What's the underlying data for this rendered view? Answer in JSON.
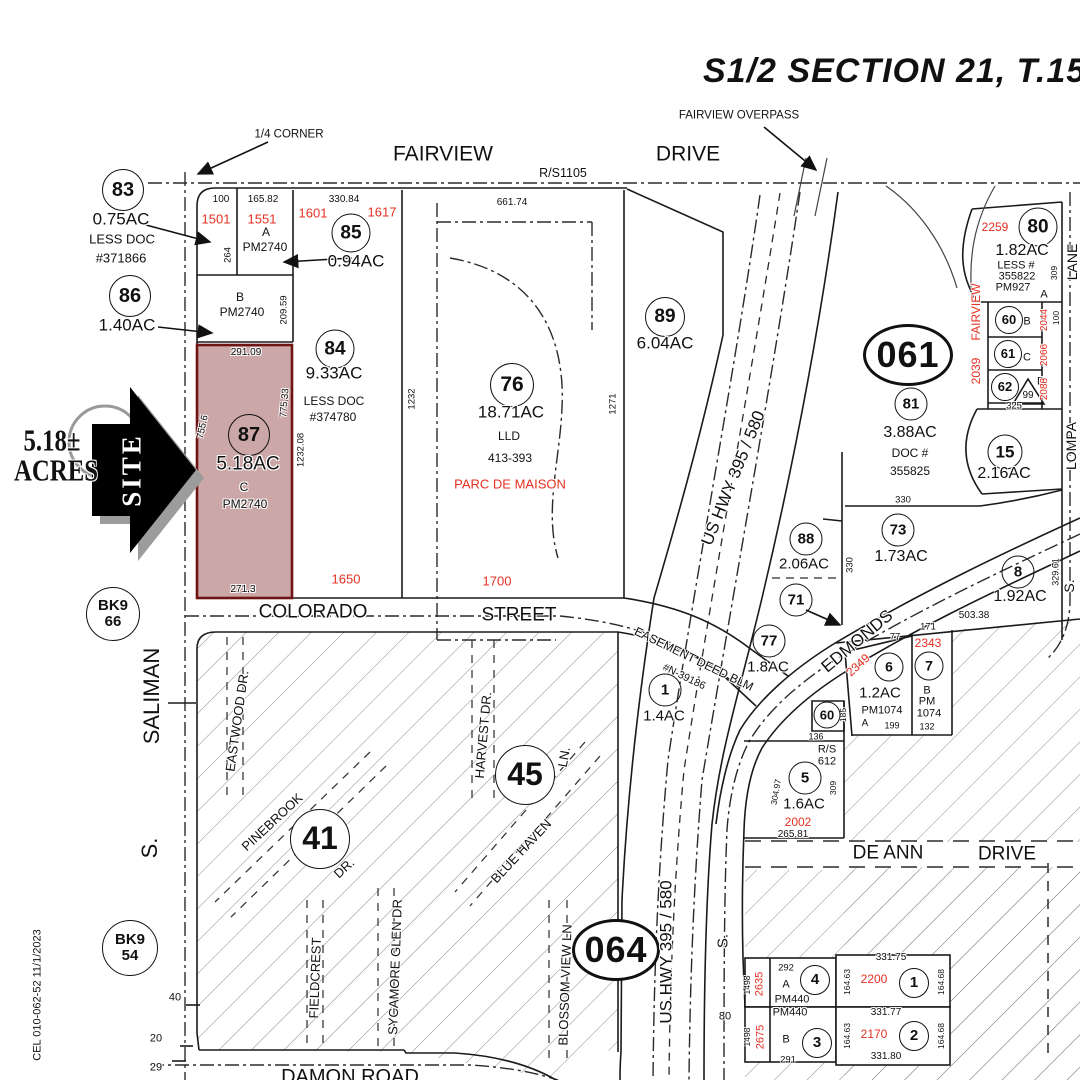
{
  "title": "S1/2 SECTION 21, T.15 N.,",
  "colors": {
    "ink": "#1a1a1a",
    "accent_red": "#e53022",
    "site_parcel_fill": "#b98888",
    "site_parcel_border": "#6f1414",
    "hatch_gray": "#8a8a8a",
    "arrow_black": "#000000",
    "arrow_shadow_gray": "#999999"
  },
  "site_callout": {
    "acreage": "5.18± ACRES",
    "arrow_label": "SITE"
  },
  "labels": [
    {
      "t": "FAIRVIEW OVERPASS",
      "x": 739,
      "y": 116,
      "s": 11.5,
      "n": "fairview-overpass-label"
    },
    {
      "t": "1/4  CORNER",
      "x": 289,
      "y": 135,
      "s": 11.5,
      "n": "quarter-corner-label"
    },
    {
      "t": "FAIRVIEW",
      "x": 443,
      "y": 154,
      "s": 21,
      "n": "street-fairview"
    },
    {
      "t": "DRIVE",
      "x": 688,
      "y": 154,
      "s": 21,
      "n": "street-fairview-drive"
    },
    {
      "t": "R/S1105",
      "x": 563,
      "y": 173,
      "s": 12.5
    },
    {
      "t": "83",
      "x": 123,
      "y": 190,
      "s": 20,
      "k": "circle",
      "d": 40,
      "n": "parcel-83"
    },
    {
      "t": "0.75AC",
      "x": 121,
      "y": 219,
      "s": 17
    },
    {
      "t": "LESS DOC",
      "x": 122,
      "y": 239,
      "s": 13
    },
    {
      "t": "#371866",
      "x": 121,
      "y": 258,
      "s": 13
    },
    {
      "t": "86",
      "x": 130,
      "y": 296,
      "s": 20,
      "k": "circle",
      "d": 40,
      "n": "parcel-86"
    },
    {
      "t": "1.40AC",
      "x": 127,
      "y": 325,
      "s": 17
    },
    {
      "t": "100",
      "x": 221,
      "y": 200,
      "s": 10
    },
    {
      "t": "165.82",
      "x": 263,
      "y": 200,
      "s": 10
    },
    {
      "t": "330.84",
      "x": 344,
      "y": 200,
      "s": 10
    },
    {
      "t": "1501",
      "x": 216,
      "y": 219,
      "s": 13,
      "c": "red"
    },
    {
      "t": "1551",
      "x": 262,
      "y": 219,
      "s": 13,
      "c": "red"
    },
    {
      "t": "1601",
      "x": 313,
      "y": 213,
      "s": 13,
      "c": "red"
    },
    {
      "t": "1617",
      "x": 382,
      "y": 212,
      "s": 13,
      "c": "red"
    },
    {
      "t": "A",
      "x": 266,
      "y": 232,
      "s": 12
    },
    {
      "t": "PM2740",
      "x": 265,
      "y": 247,
      "s": 12
    },
    {
      "t": "264",
      "x": 228,
      "y": 255,
      "s": 9.5,
      "r": -90
    },
    {
      "t": "85",
      "x": 351,
      "y": 233,
      "s": 19,
      "k": "circle",
      "d": 37,
      "n": "parcel-85"
    },
    {
      "t": "0.94AC",
      "x": 356,
      "y": 261,
      "s": 17
    },
    {
      "t": "B",
      "x": 240,
      "y": 297,
      "s": 12
    },
    {
      "t": "PM2740",
      "x": 242,
      "y": 312,
      "s": 12
    },
    {
      "t": "209.59",
      "x": 284,
      "y": 310,
      "s": 9.5,
      "r": -90
    },
    {
      "t": "84",
      "x": 335,
      "y": 349,
      "s": 19,
      "k": "circle",
      "d": 37,
      "n": "parcel-84"
    },
    {
      "t": "9.33AC",
      "x": 334,
      "y": 373,
      "s": 17
    },
    {
      "t": "LESS DOC",
      "x": 334,
      "y": 401,
      "s": 12
    },
    {
      "t": "#374780",
      "x": 333,
      "y": 417,
      "s": 12
    },
    {
      "t": "1232.08",
      "x": 301,
      "y": 450,
      "s": 9.5,
      "r": -90
    },
    {
      "t": "291.09",
      "x": 246,
      "y": 353,
      "s": 10
    },
    {
      "t": "755.6",
      "x": 203,
      "y": 427,
      "s": 9.5,
      "r": -78
    },
    {
      "t": "775.33",
      "x": 285,
      "y": 403,
      "s": 9.5,
      "r": -85
    },
    {
      "t": "87",
      "x": 249,
      "y": 435,
      "s": 20,
      "k": "circle",
      "d": 40,
      "n": "parcel-87-site"
    },
    {
      "t": "5.18AC",
      "x": 248,
      "y": 464,
      "s": 19,
      "n": "parcel-87-acreage"
    },
    {
      "t": "C",
      "x": 244,
      "y": 487,
      "s": 12
    },
    {
      "t": "PM2740",
      "x": 245,
      "y": 504,
      "s": 12
    },
    {
      "t": "271.3",
      "x": 243,
      "y": 590,
      "s": 10
    },
    {
      "t": "1650",
      "x": 346,
      "y": 579,
      "s": 13,
      "c": "red"
    },
    {
      "t": "1700",
      "x": 497,
      "y": 581,
      "s": 13,
      "c": "red"
    },
    {
      "t": "1232",
      "x": 412,
      "y": 399,
      "s": 9.5,
      "r": -90
    },
    {
      "t": "76",
      "x": 512,
      "y": 385,
      "s": 21,
      "k": "circle",
      "d": 42,
      "n": "parcel-76"
    },
    {
      "t": "18.71AC",
      "x": 511,
      "y": 412,
      "s": 17
    },
    {
      "t": "LLD",
      "x": 509,
      "y": 436,
      "s": 12
    },
    {
      "t": "413-393",
      "x": 510,
      "y": 458,
      "s": 12
    },
    {
      "t": "PARC DE MAISON",
      "x": 510,
      "y": 484,
      "s": 13,
      "c": "red",
      "n": "parc-de-maison-label"
    },
    {
      "t": "1271",
      "x": 613,
      "y": 404,
      "s": 9.5,
      "r": -90
    },
    {
      "t": "661.74",
      "x": 512,
      "y": 203,
      "s": 10
    },
    {
      "t": "89",
      "x": 665,
      "y": 317,
      "s": 19,
      "k": "circle",
      "d": 38,
      "n": "parcel-89"
    },
    {
      "t": "6.04AC",
      "x": 665,
      "y": 343,
      "s": 17
    },
    {
      "t": "2259",
      "x": 995,
      "y": 227,
      "s": 12,
      "c": "red"
    },
    {
      "t": "80",
      "x": 1038,
      "y": 227,
      "s": 19,
      "k": "circle",
      "d": 37,
      "n": "parcel-80"
    },
    {
      "t": "1.82AC",
      "x": 1022,
      "y": 251,
      "s": 16
    },
    {
      "t": "LESS #",
      "x": 1016,
      "y": 266,
      "s": 11
    },
    {
      "t": "355822",
      "x": 1017,
      "y": 277,
      "s": 11
    },
    {
      "t": "PM927",
      "x": 1013,
      "y": 288,
      "s": 11
    },
    {
      "t": "A",
      "x": 1044,
      "y": 295,
      "s": 11
    },
    {
      "t": "309",
      "x": 1054,
      "y": 273,
      "s": 8.5,
      "r": -90
    },
    {
      "t": "LANE",
      "x": 1072,
      "y": 262,
      "s": 14,
      "r": -90,
      "n": "street-lompa-lane"
    },
    {
      "t": "FAIRVIEW",
      "x": 976,
      "y": 312,
      "s": 12,
      "r": -90,
      "c": "red"
    },
    {
      "t": "2039",
      "x": 976,
      "y": 371,
      "s": 12,
      "r": -90,
      "c": "red"
    },
    {
      "t": "60",
      "x": 1009,
      "y": 320,
      "s": 13,
      "k": "circle",
      "d": 26,
      "n": "parcel-60-b"
    },
    {
      "t": "B",
      "x": 1027,
      "y": 322,
      "s": 11
    },
    {
      "t": "2044",
      "x": 1045,
      "y": 320,
      "s": 10,
      "r": -90,
      "c": "red"
    },
    {
      "t": "100",
      "x": 1056,
      "y": 318,
      "s": 8.5,
      "r": -90
    },
    {
      "t": "61",
      "x": 1008,
      "y": 354,
      "s": 13,
      "k": "circle",
      "d": 26,
      "n": "parcel-61-c"
    },
    {
      "t": "C",
      "x": 1027,
      "y": 358,
      "s": 11
    },
    {
      "t": "2066",
      "x": 1045,
      "y": 355,
      "s": 10,
      "r": -90,
      "c": "red"
    },
    {
      "t": "62",
      "x": 1005,
      "y": 387,
      "s": 13,
      "k": "circle",
      "d": 26,
      "n": "parcel-62-d"
    },
    {
      "t": "99",
      "x": 1028,
      "y": 396,
      "s": 10
    },
    {
      "t": "D",
      "x": 1041,
      "y": 382,
      "s": 11
    },
    {
      "t": "2088",
      "x": 1045,
      "y": 389,
      "s": 10,
      "r": -90,
      "c": "red"
    },
    {
      "t": "325",
      "x": 1014,
      "y": 406,
      "s": 9.5
    },
    {
      "t": "15",
      "x": 1005,
      "y": 452,
      "s": 17,
      "k": "circle",
      "d": 33,
      "n": "parcel-15"
    },
    {
      "t": "2.16AC",
      "x": 1004,
      "y": 474,
      "s": 16
    },
    {
      "t": "LOMPA",
      "x": 1071,
      "y": 446,
      "s": 14,
      "r": -90,
      "n": "street-lompa"
    },
    {
      "t": "S.",
      "x": 1069,
      "y": 586,
      "s": 14,
      "r": -90
    },
    {
      "t": "061",
      "x": 908,
      "y": 355,
      "s": 36,
      "k": "oval",
      "d": 84,
      "d2": 56,
      "n": "map-book-061"
    },
    {
      "t": "81",
      "x": 911,
      "y": 404,
      "s": 15,
      "k": "circle",
      "d": 31,
      "n": "parcel-81"
    },
    {
      "t": "3.88AC",
      "x": 910,
      "y": 433,
      "s": 16
    },
    {
      "t": "DOC #",
      "x": 910,
      "y": 453,
      "s": 12
    },
    {
      "t": "355825",
      "x": 910,
      "y": 471,
      "s": 12
    },
    {
      "t": "330",
      "x": 903,
      "y": 500,
      "s": 9.5
    },
    {
      "t": "73",
      "x": 898,
      "y": 530,
      "s": 15,
      "k": "circle",
      "d": 31,
      "n": "parcel-73"
    },
    {
      "t": "1.73AC",
      "x": 901,
      "y": 557,
      "s": 16
    },
    {
      "t": "88",
      "x": 806,
      "y": 539,
      "s": 15,
      "k": "circle",
      "d": 31,
      "n": "parcel-88"
    },
    {
      "t": "2.06AC",
      "x": 804,
      "y": 564,
      "s": 15
    },
    {
      "t": "71",
      "x": 796,
      "y": 600,
      "s": 15,
      "k": "circle",
      "d": 31,
      "n": "parcel-71"
    },
    {
      "t": "330",
      "x": 850,
      "y": 565,
      "s": 9.5,
      "r": -90
    },
    {
      "t": "US  HWY  395 / 580",
      "x": 733,
      "y": 478,
      "s": 17,
      "r": -68,
      "n": "street-us-hwy-upper"
    },
    {
      "t": "8",
      "x": 1018,
      "y": 572,
      "s": 15,
      "k": "circle",
      "d": 31,
      "n": "parcel-8"
    },
    {
      "t": "1.92AC",
      "x": 1020,
      "y": 597,
      "s": 16
    },
    {
      "t": "503.38",
      "x": 974,
      "y": 616,
      "s": 10
    },
    {
      "t": "329.61",
      "x": 1056,
      "y": 572,
      "s": 9,
      "r": -90
    },
    {
      "t": "EDMONDS",
      "x": 857,
      "y": 641,
      "s": 17,
      "r": -40,
      "n": "street-edmonds"
    },
    {
      "t": "171",
      "x": 928,
      "y": 627,
      "s": 9.5
    },
    {
      "t": "77",
      "x": 895,
      "y": 637,
      "s": 9.5
    },
    {
      "t": "2343",
      "x": 928,
      "y": 643,
      "s": 12,
      "c": "red"
    },
    {
      "t": "2349",
      "x": 858,
      "y": 665,
      "s": 12,
      "r": -42,
      "c": "red"
    },
    {
      "t": "6",
      "x": 889,
      "y": 667,
      "s": 14,
      "k": "circle",
      "d": 27,
      "n": "parcel-6"
    },
    {
      "t": "1.2AC",
      "x": 880,
      "y": 693,
      "s": 15
    },
    {
      "t": "PM1074",
      "x": 882,
      "y": 711,
      "s": 11
    },
    {
      "t": "A",
      "x": 865,
      "y": 724,
      "s": 10
    },
    {
      "t": "199",
      "x": 892,
      "y": 726,
      "s": 9
    },
    {
      "t": "185",
      "x": 843,
      "y": 715,
      "s": 8.5,
      "r": -90
    },
    {
      "t": "7",
      "x": 929,
      "y": 666,
      "s": 14,
      "k": "circle",
      "d": 27,
      "n": "parcel-7"
    },
    {
      "t": "B",
      "x": 927,
      "y": 691,
      "s": 11
    },
    {
      "t": "PM",
      "x": 927,
      "y": 702,
      "s": 11
    },
    {
      "t": "1074",
      "x": 929,
      "y": 714,
      "s": 11
    },
    {
      "t": "132",
      "x": 927,
      "y": 727,
      "s": 9
    },
    {
      "t": "60",
      "x": 827,
      "y": 715,
      "s": 13,
      "k": "circle",
      "d": 25,
      "n": "parcel-60"
    },
    {
      "t": "136",
      "x": 816,
      "y": 737,
      "s": 9
    },
    {
      "t": "R/S",
      "x": 827,
      "y": 750,
      "s": 11
    },
    {
      "t": "612",
      "x": 827,
      "y": 762,
      "s": 11
    },
    {
      "t": "77",
      "x": 769,
      "y": 641,
      "s": 15,
      "k": "circle",
      "d": 31,
      "n": "parcel-77"
    },
    {
      "t": "1.8AC",
      "x": 768,
      "y": 667,
      "s": 15
    },
    {
      "t": "EASEMENT DEED BLM",
      "x": 694,
      "y": 659,
      "s": 12,
      "r": 26,
      "n": "easement-label"
    },
    {
      "t": "#N-39186",
      "x": 684,
      "y": 677,
      "s": 10.5,
      "r": 26
    },
    {
      "t": "1",
      "x": 665,
      "y": 690,
      "s": 15,
      "k": "circle",
      "d": 31,
      "n": "parcel-1"
    },
    {
      "t": "1.4AC",
      "x": 664,
      "y": 716,
      "s": 15
    },
    {
      "t": "5",
      "x": 805,
      "y": 778,
      "s": 15,
      "k": "circle",
      "d": 31,
      "n": "parcel-5"
    },
    {
      "t": "1.6AC",
      "x": 804,
      "y": 804,
      "s": 15
    },
    {
      "t": "2002",
      "x": 798,
      "y": 822,
      "s": 12,
      "c": "red"
    },
    {
      "t": "265.81",
      "x": 793,
      "y": 835,
      "s": 10
    },
    {
      "t": "309",
      "x": 833,
      "y": 788,
      "s": 8.5,
      "r": -90
    },
    {
      "t": "304.97",
      "x": 776,
      "y": 792,
      "s": 8.5,
      "r": -80
    },
    {
      "t": "COLORADO",
      "x": 313,
      "y": 612,
      "s": 19,
      "n": "street-colorado"
    },
    {
      "t": "STREET",
      "x": 519,
      "y": 615,
      "s": 19,
      "n": "street-colorado-street"
    },
    {
      "t": "BK9\n66",
      "x": 113,
      "y": 614,
      "s": 15,
      "k": "circle",
      "d": 52,
      "bg": 1,
      "n": "bk9-66"
    },
    {
      "t": "SALIMAN",
      "x": 152,
      "y": 696,
      "s": 22,
      "r": -90,
      "n": "street-saliman"
    },
    {
      "t": "S.",
      "x": 150,
      "y": 848,
      "s": 22,
      "r": -90
    },
    {
      "t": "41",
      "x": 320,
      "y": 839,
      "s": 32,
      "k": "circle",
      "d": 58,
      "bg": 1,
      "n": "block-41"
    },
    {
      "t": "45",
      "x": 525,
      "y": 775,
      "s": 32,
      "k": "circle",
      "d": 58,
      "bg": 1,
      "n": "block-45"
    },
    {
      "t": "EASTWOOD DR.",
      "x": 237,
      "y": 721,
      "s": 13,
      "r": -82,
      "n": "street-eastwood"
    },
    {
      "t": "PINEBROOK",
      "x": 272,
      "y": 822,
      "s": 13,
      "r": -43,
      "n": "street-pinebrook"
    },
    {
      "t": "DR.",
      "x": 344,
      "y": 868,
      "s": 13,
      "r": -43
    },
    {
      "t": "HARVEST DR.",
      "x": 483,
      "y": 735,
      "s": 13,
      "r": -85,
      "n": "street-harvest"
    },
    {
      "t": "BLUE HAVEN",
      "x": 521,
      "y": 851,
      "s": 13,
      "r": -47,
      "n": "street-blue-haven"
    },
    {
      "t": "LN.",
      "x": 564,
      "y": 757,
      "s": 13,
      "r": -80
    },
    {
      "t": "FIELDCREST",
      "x": 315,
      "y": 978,
      "s": 13,
      "r": -88,
      "n": "street-fieldcrest"
    },
    {
      "t": "SYCAMORE GLEN DR",
      "x": 395,
      "y": 967,
      "s": 13,
      "r": -88,
      "n": "street-sycamore-glen"
    },
    {
      "t": "BLOSSOM VIEW LN",
      "x": 565,
      "y": 985,
      "s": 13,
      "r": -88,
      "n": "street-blossom-view"
    },
    {
      "t": "BK9\n54",
      "x": 130,
      "y": 948,
      "s": 15,
      "k": "circle",
      "d": 54,
      "bg": 1,
      "n": "bk9-54"
    },
    {
      "t": "40",
      "x": 175,
      "y": 998,
      "s": 11
    },
    {
      "t": "20",
      "x": 156,
      "y": 1039,
      "s": 11
    },
    {
      "t": "29",
      "x": 156,
      "y": 1068,
      "s": 11
    },
    {
      "t": "DAMON  ROAD",
      "x": 350,
      "y": 1077,
      "s": 20,
      "n": "street-damon-road"
    },
    {
      "t": "064",
      "x": 616,
      "y": 950,
      "s": 36,
      "k": "oval",
      "d": 82,
      "d2": 56,
      "n": "map-book-064"
    },
    {
      "t": "US  HWY  395 / 580",
      "x": 666,
      "y": 952,
      "s": 17,
      "r": -90,
      "n": "street-us-hwy-lower"
    },
    {
      "t": "S.",
      "x": 723,
      "y": 941,
      "s": 15,
      "r": -90
    },
    {
      "t": "80",
      "x": 725,
      "y": 1017,
      "s": 11
    },
    {
      "t": "DE  ANN",
      "x": 888,
      "y": 853,
      "s": 19,
      "n": "street-de-ann"
    },
    {
      "t": "DRIVE",
      "x": 1007,
      "y": 854,
      "s": 19,
      "n": "street-de-ann-drive"
    },
    {
      "t": "292",
      "x": 786,
      "y": 968,
      "s": 9.5
    },
    {
      "t": "2635",
      "x": 760,
      "y": 984,
      "s": 11,
      "r": -90,
      "c": "red"
    },
    {
      "t": "1498",
      "x": 747,
      "y": 985,
      "s": 8.5,
      "r": -90
    },
    {
      "t": "4",
      "x": 815,
      "y": 980,
      "s": 15,
      "k": "circle",
      "d": 28,
      "n": "parcel-4"
    },
    {
      "t": "A",
      "x": 786,
      "y": 985,
      "s": 11
    },
    {
      "t": "PM440",
      "x": 792,
      "y": 1000,
      "s": 11
    },
    {
      "t": "331.75",
      "x": 891,
      "y": 958,
      "s": 10
    },
    {
      "t": "2200",
      "x": 874,
      "y": 979,
      "s": 12,
      "c": "red"
    },
    {
      "t": "1",
      "x": 914,
      "y": 983,
      "s": 15,
      "k": "circle",
      "d": 28,
      "n": "parcel-1-south"
    },
    {
      "t": "164.63",
      "x": 847,
      "y": 982,
      "s": 8.5,
      "r": -90
    },
    {
      "t": "164.68",
      "x": 941,
      "y": 982,
      "s": 8.5,
      "r": -90
    },
    {
      "t": "PM440",
      "x": 790,
      "y": 1013,
      "s": 11
    },
    {
      "t": "2675",
      "x": 761,
      "y": 1037,
      "s": 11,
      "r": -90,
      "c": "red"
    },
    {
      "t": "1498",
      "x": 747,
      "y": 1037,
      "s": 8.5,
      "r": -90
    },
    {
      "t": "B",
      "x": 786,
      "y": 1040,
      "s": 11
    },
    {
      "t": "3",
      "x": 817,
      "y": 1043,
      "s": 15,
      "k": "circle",
      "d": 28,
      "n": "parcel-3"
    },
    {
      "t": "291",
      "x": 788,
      "y": 1060,
      "s": 9.5
    },
    {
      "t": "331.77",
      "x": 886,
      "y": 1013,
      "s": 10
    },
    {
      "t": "2170",
      "x": 874,
      "y": 1034,
      "s": 12,
      "c": "red"
    },
    {
      "t": "2",
      "x": 914,
      "y": 1036,
      "s": 15,
      "k": "circle",
      "d": 28,
      "n": "parcel-2"
    },
    {
      "t": "164.63",
      "x": 847,
      "y": 1036,
      "s": 8.5,
      "r": -90
    },
    {
      "t": "164.68",
      "x": 941,
      "y": 1036,
      "s": 8.5,
      "r": -90
    },
    {
      "t": "331.80",
      "x": 886,
      "y": 1057,
      "s": 10
    },
    {
      "t": "CEL  010-062-52  11/1/2023",
      "x": 38,
      "y": 995,
      "s": 11,
      "r": -90,
      "n": "parcel-id-footer"
    },
    {
      "t": "5.18±",
      "x": 52,
      "y": 440,
      "s": 31,
      "k": "serif",
      "sx": 0.8,
      "n": "site-acreage-line1"
    },
    {
      "t": "ACRES",
      "x": 56,
      "y": 470,
      "s": 31,
      "k": "serif",
      "sx": 0.8,
      "n": "site-acreage-line2"
    },
    {
      "t": "SITE",
      "x": 132,
      "y": 470,
      "s": 27,
      "r": -90,
      "k": "serif",
      "c": "white",
      "ls": 3,
      "n": "site-arrow-label"
    }
  ]
}
